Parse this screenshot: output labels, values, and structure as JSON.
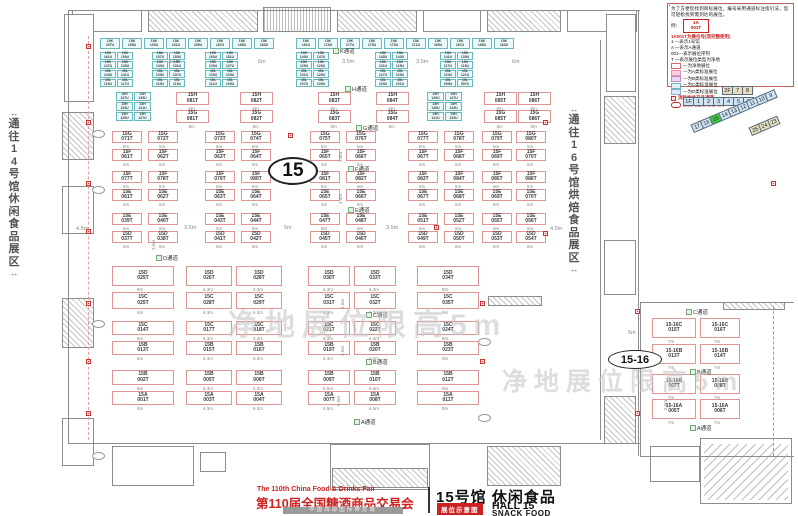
{
  "title_block": {
    "fair_en": "The 110th China Food & Drinks Fair",
    "fair_cn": "第110届全国糖酒商品交易会",
    "venue": "中国西部国际博览城",
    "hall_cn": "15号馆 休闲食品",
    "hall_en": "HALL 15",
    "hall_sub": "SNACK FOOD",
    "badge": "展位示意图"
  },
  "legend": {
    "intro": "为了方便您找到目标展位，编号采用通道标注指引法，您可轻松找到需到达的展位。",
    "example_label": "例：",
    "example_line1": "1A",
    "example_line2": "001T",
    "headline": "1A001T为展位号(须完整使用)",
    "items": [
      "1 —表示1号馆",
      "A —表示A通道",
      "001—表示展位序列",
      "T —表示展位类型为净地"
    ],
    "categories": [
      {
        "label": "—为净地展位",
        "fill": "#ffffff",
        "border": "#d96a6a"
      },
      {
        "label": "—为A类标准展位",
        "fill": "#fbd3de",
        "border": "#e394ad"
      },
      {
        "label": "—为B类标准展位",
        "fill": "#ecd6f2",
        "border": "#b98cc9"
      },
      {
        "label": "—为C类标准展位",
        "fill": "#dff3f3",
        "border": "#6ab8bc"
      },
      {
        "label": "—为D类标准展位",
        "fill": "#d9e8f8",
        "border": "#86aed2"
      }
    ],
    "fire_note": "消防栓井产品通道",
    "pillar_note": "展位内立柱 直径均为1.5m"
  },
  "minimap": {
    "f2": [
      "2F",
      "7",
      "8"
    ],
    "f1": [
      "1F",
      "1",
      "2",
      "3",
      "4",
      "5",
      "6"
    ],
    "diag": [
      "17",
      "16",
      "15",
      "14",
      "13",
      "12",
      "11",
      "10",
      "9"
    ],
    "diag_highlight": "15",
    "highlight_color": "#3ecc3e",
    "diag2": [
      "25",
      "24",
      "23"
    ]
  },
  "corridors": {
    "left": "通往14号馆休闲食品展区",
    "right": "通往16号馆烘焙食品展区",
    "arrow": "↔"
  },
  "watermark": "净地展位限高5m",
  "ovals": {
    "main": "15",
    "right": "15-16"
  },
  "aisles": [
    {
      "t": "K通道",
      "x": 333,
      "y": 47
    },
    {
      "t": "H通道",
      "x": 345,
      "y": 85
    },
    {
      "t": "G通道",
      "x": 356,
      "y": 124
    },
    {
      "t": "F通道",
      "x": 348,
      "y": 165
    },
    {
      "t": "E通道",
      "x": 348,
      "y": 206
    },
    {
      "t": "D通道",
      "x": 156,
      "y": 254
    },
    {
      "t": "C通道",
      "x": 366,
      "y": 311
    },
    {
      "t": "B通道",
      "x": 366,
      "y": 358
    },
    {
      "t": "A通道",
      "x": 354,
      "y": 418
    },
    {
      "t": "C通道",
      "x": 686,
      "y": 308
    },
    {
      "t": "B通道",
      "x": 690,
      "y": 368
    },
    {
      "t": "A通道",
      "x": 690,
      "y": 424
    }
  ],
  "dims": [
    {
      "t": "3.5m",
      "x": 168,
      "y": 59
    },
    {
      "t": "6m",
      "x": 258,
      "y": 59
    },
    {
      "t": "3.5m",
      "x": 342,
      "y": 59
    },
    {
      "t": "3.5m",
      "x": 416,
      "y": 59
    },
    {
      "t": "6m",
      "x": 512,
      "y": 59
    },
    {
      "t": "4.5m",
      "x": 76,
      "y": 226
    },
    {
      "t": "3.5m",
      "x": 184,
      "y": 225
    },
    {
      "t": "6m",
      "x": 284,
      "y": 225
    },
    {
      "t": "3.5m",
      "x": 386,
      "y": 225
    },
    {
      "t": "4.5m",
      "x": 550,
      "y": 226
    },
    {
      "t": "5m",
      "x": 628,
      "y": 330
    },
    {
      "t": "3.5m",
      "x": 338,
      "y": 162,
      "r": 1
    },
    {
      "t": "3.5m",
      "x": 338,
      "y": 204,
      "r": 1
    },
    {
      "t": "3.5m",
      "x": 151,
      "y": 250,
      "r": 1
    },
    {
      "t": "3.5m",
      "x": 340,
      "y": 309,
      "r": 1
    },
    {
      "t": "3.5m",
      "x": 340,
      "y": 356,
      "r": 1
    },
    {
      "t": "5.5m",
      "x": 336,
      "y": 406,
      "r": 1
    },
    {
      "t": "5.5m",
      "x": 663,
      "y": 410,
      "r": 1
    }
  ],
  "plan": {
    "cyan_top": {
      "y": 38,
      "h": 11,
      "w": 20,
      "gap": 2,
      "p": "15K",
      "clusters": [
        {
          "x": 100,
          "n": [
            "197U",
            "195U",
            "193U",
            "191U",
            "189U",
            "187U",
            "185U",
            "183U"
          ]
        },
        {
          "x": 296,
          "n": [
            "181U",
            "179U",
            "177U",
            "175U",
            "173U",
            "171U",
            "169U",
            "167U",
            "165U",
            "163U"
          ]
        }
      ]
    },
    "cyan_block": {
      "ys": [
        52,
        61,
        70,
        79
      ],
      "h": 8,
      "w": 16,
      "gap": 1,
      "cluster_x": [
        100,
        152,
        205,
        296,
        375,
        440
      ],
      "rows": [
        {
          "p": "15K",
          "n": [
            "161U",
            "159U",
            "157U",
            "155U",
            "153U",
            "151U",
            "149U",
            "147U",
            "145U",
            "143U",
            "141U",
            "139U"
          ]
        },
        {
          "p": "15K",
          "n": [
            "137U",
            "135U",
            "133U",
            "131U",
            "129U",
            "127U",
            "125U",
            "123U",
            "121U",
            "119U",
            "117U",
            "115U"
          ]
        },
        {
          "p": "15L",
          "n": [
            "143U",
            "141U",
            "139U",
            "137U",
            "135U",
            "133U",
            "131U",
            "129U",
            "127U",
            "125U",
            "123U",
            "121U"
          ]
        },
        {
          "p": "15L",
          "n": [
            "119U",
            "117U",
            "115U",
            "113U",
            "111U",
            "109U",
            "107U",
            "105U",
            "103U",
            "101U",
            "099U",
            "097U"
          ]
        }
      ]
    },
    "cyan_grids": [
      {
        "x": 116,
        "ys": [
          92,
          102,
          112
        ],
        "w": 17,
        "h": 9,
        "p": "15H",
        "rows": [
          [
            "137U",
            "135U"
          ],
          [
            "133U",
            "131U"
          ],
          [
            "129U",
            "127U"
          ]
        ]
      },
      {
        "x": 427,
        "ys": [
          92,
          102,
          112
        ],
        "w": 17,
        "h": 9,
        "p": "15H",
        "rows": [
          [
            "149U",
            "147U"
          ],
          [
            "145U",
            "143U"
          ],
          [
            "141U",
            "139U"
          ]
        ]
      }
    ],
    "red_rows_top": {
      "cols": [
        176,
        240,
        318,
        376,
        484,
        518
      ],
      "w": 33,
      "h": 13,
      "dim": "8m",
      "rows": [
        {
          "y": 92,
          "p": "15H",
          "n": [
            "081T",
            "082T",
            "083T",
            "084T",
            "085T",
            "086T"
          ]
        },
        {
          "y": 110,
          "p": "15G",
          "n": [
            "081T",
            "082T",
            "083T",
            "084T",
            "085T",
            "086T"
          ]
        }
      ]
    },
    "red_rows_mid": {
      "cols": [
        112,
        148,
        205,
        241,
        310,
        346,
        408,
        444,
        482,
        516
      ],
      "w": 30,
      "h": 12,
      "dim": "6m",
      "rows": [
        {
          "y": 131,
          "p": "15G",
          "n": [
            "071T",
            "072T",
            "073T",
            "074T",
            "075T",
            "076T",
            "077T",
            "078T",
            "079T",
            "080T"
          ]
        },
        {
          "y": 149,
          "p": "15F",
          "n": [
            "061T",
            "062T",
            "063T",
            "064T",
            "065T",
            "066T",
            "067T",
            "068T",
            "069T",
            "070T"
          ]
        },
        {
          "y": 171,
          "p": "15F",
          "n": [
            "077T",
            "078T",
            "079T",
            "080T",
            "081T",
            "082T",
            "083T",
            "084T",
            "085T",
            "086T"
          ]
        },
        {
          "y": 189,
          "p": "15E",
          "n": [
            "061T",
            "062T",
            "063T",
            "064T",
            "065T",
            "066T",
            "067T",
            "068T",
            "069T",
            "070T"
          ]
        },
        {
          "y": 213,
          "p": "15E",
          "n": [
            "039T",
            "040T",
            "043T",
            "044T",
            "047T",
            "048T",
            "051T",
            "052T",
            "055T",
            "056T"
          ]
        },
        {
          "y": 231,
          "p": "15D",
          "n": [
            "037T",
            "038T",
            "041T",
            "042T",
            "045T",
            "046T",
            "049T",
            "050T",
            "053T",
            "054T"
          ]
        }
      ]
    },
    "red_rows_low": {
      "cols": [
        {
          "x": 112,
          "w": 62
        },
        {
          "x": 186,
          "w": 46
        },
        {
          "x": 236,
          "w": 46
        },
        {
          "x": 308,
          "w": 42
        },
        {
          "x": 354,
          "w": 42
        },
        {
          "x": 417,
          "w": 62
        }
      ],
      "rows": [
        {
          "y": 266,
          "h": 20,
          "p": "15D",
          "n": [
            "025T",
            "026T",
            "028T",
            "030T",
            "033T",
            "034T"
          ],
          "dims": [
            "8m",
            "6.3m",
            "6.3m",
            "6.3m",
            "6.3m",
            "9m"
          ]
        },
        {
          "y": 292,
          "h": 17,
          "p": "15C",
          "n": [
            "025T",
            "028T",
            "029T",
            "031T",
            "032T",
            "035T"
          ],
          "dims": [
            "8m",
            "6.3m",
            "6.3m",
            "6.3m",
            "6.3m",
            "9m"
          ]
        },
        {
          "y": 321,
          "h": 14,
          "p": "15C",
          "n": [
            "014T",
            "017T",
            "018T",
            "021T",
            "022T",
            "024T"
          ],
          "dims": [
            "8m",
            "6.3m",
            "6.3m",
            "6.3m",
            "6.3m",
            "9m"
          ]
        },
        {
          "y": 341,
          "h": 14,
          "p": "15B",
          "n": [
            "013T",
            "015T",
            "016T",
            "019T",
            "020T",
            "023T"
          ],
          "dims": [
            "8m",
            "6.3m",
            "6.3m",
            "6.3m",
            "6.3m",
            "9m"
          ]
        },
        {
          "y": 370,
          "h": 15,
          "p": "15B",
          "n": [
            "002T",
            "005T",
            "006T",
            "009T",
            "010T",
            "012T"
          ],
          "dims": [
            "8m",
            "6.3m",
            "6.3m",
            "6.5m",
            "6.5m",
            "9m"
          ]
        },
        {
          "y": 391,
          "h": 14,
          "p": "15A",
          "n": [
            "001T",
            "003T",
            "004T",
            "007T",
            "008T",
            "011T"
          ],
          "dims": [
            "8m",
            "6.3m",
            "6.3m",
            "6.5m",
            "6.5m",
            "9m"
          ]
        }
      ]
    },
    "right_rows": {
      "cols": [
        {
          "x": 652,
          "w": 44
        },
        {
          "x": 700,
          "w": 40
        }
      ],
      "rows": [
        {
          "y": 318,
          "h": 20,
          "p": "15-16C",
          "n": [
            "015T",
            "016T"
          ],
          "dims": [
            "7m",
            "7m"
          ]
        },
        {
          "y": 344,
          "h": 20,
          "p": "15-16B",
          "n": [
            "013T",
            "014T"
          ],
          "dims": [
            "7m",
            "7m"
          ]
        },
        {
          "y": 374,
          "h": 20,
          "p": "15-16B",
          "n": [
            "007T",
            "008T"
          ],
          "dims": [
            "7m",
            "7m"
          ]
        },
        {
          "y": 399,
          "h": 20,
          "p": "15-16A",
          "n": [
            "005T",
            "006T"
          ],
          "dims": [
            "7m",
            "7m"
          ]
        }
      ]
    },
    "hydrants": [
      [
        86,
        44
      ],
      [
        86,
        120
      ],
      [
        86,
        181
      ],
      [
        86,
        229
      ],
      [
        86,
        301
      ],
      [
        86,
        359
      ],
      [
        86,
        411
      ],
      [
        288,
        133
      ],
      [
        288,
        180
      ],
      [
        434,
        225
      ],
      [
        480,
        301
      ],
      [
        480,
        359
      ],
      [
        543,
        120
      ],
      [
        543,
        231
      ],
      [
        635,
        309
      ],
      [
        635,
        411
      ],
      [
        771,
        181
      ]
    ],
    "structures": [
      [
        72,
        10,
        70,
        22,
        "s"
      ],
      [
        148,
        10,
        110,
        22,
        "h"
      ],
      [
        263,
        7,
        68,
        25,
        "g"
      ],
      [
        337,
        10,
        80,
        22,
        "h"
      ],
      [
        423,
        10,
        58,
        22,
        "s"
      ],
      [
        487,
        10,
        74,
        22,
        "h"
      ],
      [
        567,
        10,
        70,
        22,
        "s"
      ],
      [
        64,
        14,
        30,
        88,
        "s"
      ],
      [
        606,
        14,
        30,
        78,
        "s"
      ],
      [
        62,
        112,
        32,
        48,
        "h"
      ],
      [
        62,
        186,
        32,
        48,
        "s"
      ],
      [
        62,
        298,
        32,
        50,
        "h"
      ],
      [
        62,
        418,
        32,
        48,
        "s"
      ],
      [
        604,
        96,
        32,
        48,
        "h"
      ],
      [
        604,
        240,
        32,
        55,
        "s"
      ],
      [
        604,
        396,
        32,
        48,
        "h"
      ],
      [
        112,
        446,
        82,
        40,
        "s"
      ],
      [
        200,
        452,
        26,
        20,
        "s"
      ],
      [
        330,
        444,
        100,
        46,
        "s"
      ],
      [
        332,
        468,
        96,
        20,
        "h"
      ],
      [
        487,
        446,
        74,
        40,
        "h"
      ],
      [
        650,
        446,
        50,
        36,
        "s"
      ],
      [
        700,
        438,
        92,
        66,
        "s"
      ],
      [
        704,
        444,
        84,
        56,
        "diagp"
      ],
      [
        488,
        296,
        54,
        10,
        "h"
      ],
      [
        723,
        302,
        62,
        8,
        "h"
      ]
    ],
    "lines": [
      [
        68,
        10,
        572,
        1
      ],
      [
        68,
        10,
        1,
        434
      ],
      [
        638,
        10,
        1,
        446
      ],
      [
        68,
        443,
        572,
        1
      ],
      [
        600,
        40,
        1,
        400
      ],
      [
        640,
        302,
        154,
        1
      ],
      [
        640,
        456,
        154,
        1
      ],
      [
        640,
        302,
        1,
        155
      ]
    ],
    "dashes": [
      {
        "x": 88,
        "y": 36,
        "len": 404,
        "v": 1,
        "c": "#e8a0a0"
      },
      {
        "x": 773,
        "y": 306,
        "len": 150,
        "v": 1,
        "c": "#9a9a9a"
      }
    ],
    "columns": [
      [
        92,
        130
      ],
      [
        92,
        186
      ],
      [
        92,
        320
      ],
      [
        92,
        452
      ],
      [
        478,
        338
      ],
      [
        478,
        414
      ]
    ]
  }
}
